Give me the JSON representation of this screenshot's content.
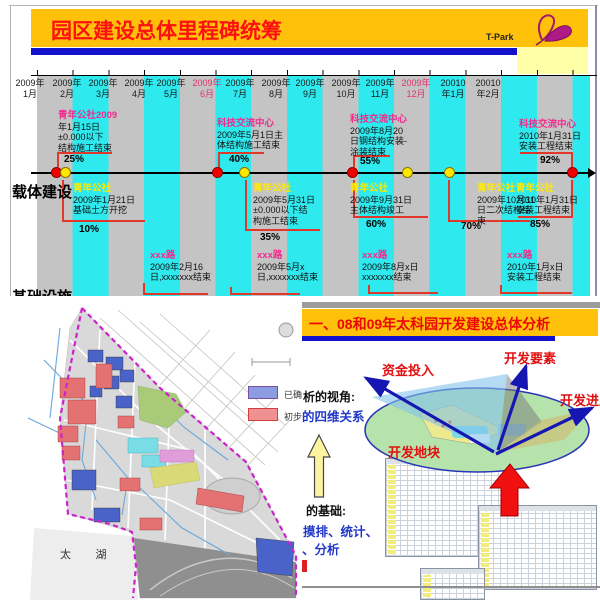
{
  "top_slide": {
    "title": "园区建设总体里程碑统筹",
    "logo_text": "T-Park",
    "row_labels": {
      "carrier": "载体建设",
      "infrastructure": "基础设施"
    },
    "months": [
      {
        "y": "2009年",
        "m": "1月"
      },
      {
        "y": "2009年",
        "m": "2月"
      },
      {
        "y": "2009年",
        "m": "3月"
      },
      {
        "y": "2009年",
        "m": "4月"
      },
      {
        "y": "2009年",
        "m": "5月"
      },
      {
        "y": "2009年",
        "m": "6月"
      },
      {
        "y": "2009年",
        "m": "7月"
      },
      {
        "y": "2009年",
        "m": "8月"
      },
      {
        "y": "2009年",
        "m": "9月"
      },
      {
        "y": "2009年",
        "m": "10月"
      },
      {
        "y": "2009年",
        "m": "11月"
      },
      {
        "y": "2009年",
        "m": "12月"
      },
      {
        "y": "20010",
        "m": "年1月"
      },
      {
        "y": "20010",
        "m": "年2月"
      }
    ],
    "milestones_above": [
      {
        "title": "青年公社2009",
        "l1": "年1月15日",
        "l2": "±0.000以下",
        "l3": "结构施工结束",
        "pct": "25%"
      },
      {
        "title": "科技交流中心",
        "l1": "2009年5月1日主",
        "l2": "体结构施工结束",
        "pct": "40%"
      },
      {
        "title": "科技交流中心",
        "l1": "2009年8月20",
        "l2": "日钢结构安装-",
        "l3": "涂装结束",
        "pct": "55%"
      },
      {
        "title": "科技交流中心",
        "l1": "2010年1月31日",
        "l2": "安装工程结束",
        "pct": "92%"
      }
    ],
    "milestones_below": [
      {
        "title": "青年公社",
        "l1": "2009年1月21日",
        "l2": "基础土方开挖",
        "pct": "10%"
      },
      {
        "title": "青年公社",
        "l1": "2009年5月31日",
        "l2": "±0.000以下结",
        "l3": "构施工结束",
        "pct": "35%"
      },
      {
        "title": "青年公社",
        "l1": "2009年9月31日",
        "l2": "主体结构竣工",
        "pct": "60%"
      },
      {
        "title": "青年公社",
        "l1": "2009年10月31",
        "l2": "日二次结构结",
        "l3": "束",
        "pct": "70%"
      },
      {
        "title": "青年公社",
        "l1": "2010年1月31日",
        "l2": "安装工程结束",
        "pct": "85%"
      }
    ],
    "road_milestones": [
      {
        "title": "xxx路",
        "l1": "2009年2月16",
        "l2": "日,xxxxxxx结束"
      },
      {
        "title": "xxx路",
        "l1": "2009年5月x",
        "l2": "日,xxxxxxx结束"
      },
      {
        "title": "xxx路",
        "l1": "2009年8月x日",
        "l2": "xxxxxxx结束"
      },
      {
        "title": "xxx路",
        "l1": "2010年1月x日",
        "l2": "安装工程结束"
      }
    ]
  },
  "map_panel": {
    "lake_label": "太        湖",
    "legend": {
      "confirmed": "已确定",
      "preliminary": "初步确定"
    }
  },
  "right_slide": {
    "title": "一、08和09年太科园开发建设总体分析",
    "arrow_labels": {
      "capital": "资金投入",
      "elements": "开发要素",
      "progress": "开发进度",
      "plots": "开发地块"
    },
    "view_line1": "析的视角:",
    "view_line2": "的四维关系",
    "base_line1": "的基础:",
    "base_line2": "摸排、统计、",
    "base_line3": "、分析"
  },
  "colors": {
    "header_yellow": "#FFC10A",
    "title_red": "#FF0F0F",
    "bar_blue": "#1212CC",
    "band_gray": "#C4C4C4",
    "band_cyan": "#2EE9EE",
    "dot_red": "#F20000",
    "dot_yellow": "#FFE800",
    "milestone_pink": "#F12A8D",
    "milestone_yellow": "#FFE900",
    "callout_red": "#E0392C",
    "ellipse_green": "#B6E2AC",
    "arrow_blue": "#1616B2",
    "legend_blue": "#8C9CE0",
    "legend_red": "#F09090"
  }
}
